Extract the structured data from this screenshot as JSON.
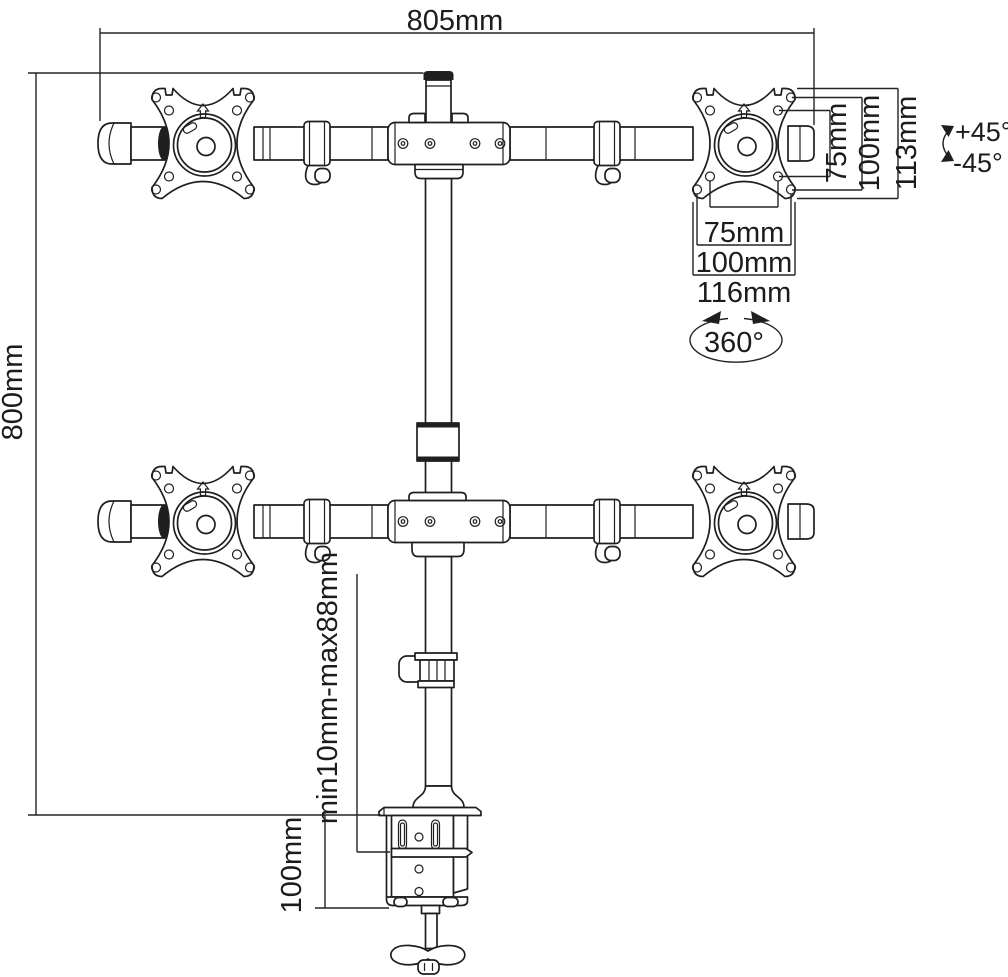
{
  "diagram": {
    "subject": "Quad monitor desk mount arm — dimensional technical drawing",
    "background": "#ffffff",
    "line_color": "#1f1f1f",
    "annotations": {
      "overall_width": "805mm",
      "overall_height": "800mm",
      "vesa_vertical_inner": "75mm",
      "vesa_vertical_outer": "100mm",
      "plate_height": "113mm",
      "tilt_up": "+45°",
      "tilt_down": "-45°",
      "vesa_horizontal_inner": "75mm",
      "vesa_horizontal_outer": "100mm",
      "plate_width": "116mm",
      "swivel": "360°",
      "clamp_range": "min10mm-max88mm",
      "clamp_height": "100mm"
    }
  }
}
